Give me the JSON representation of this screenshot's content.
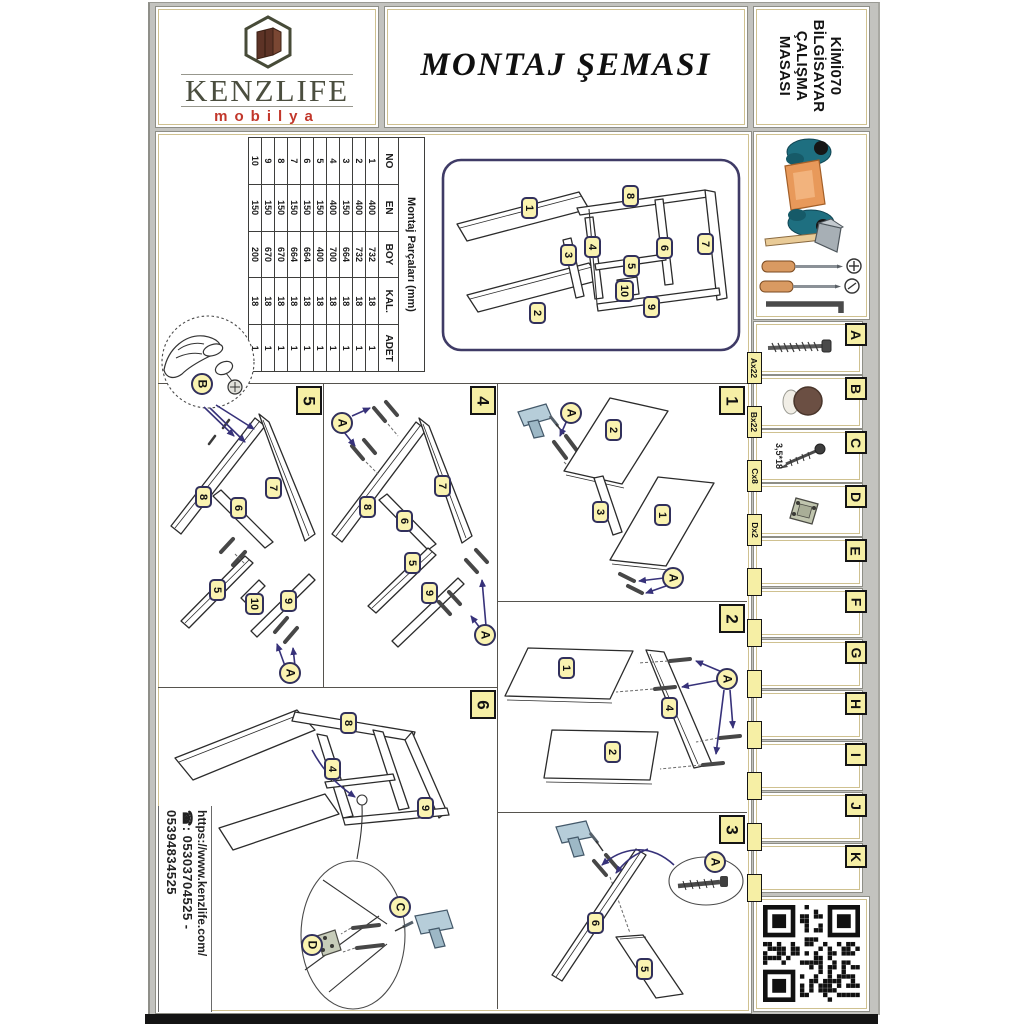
{
  "brand": {
    "name": "KENZLIFE",
    "sub": "mobilya"
  },
  "header": {
    "title": "MONTAJ ŞEMASI"
  },
  "product": {
    "line1": "KİMİ070",
    "line2": "BİLGİSAYAR",
    "line3": "ÇALIŞMA",
    "line4": "MASASI"
  },
  "contact": {
    "phone_icon": "☎",
    "phone": ": 05303704525 - 05394834525",
    "url": "https://www.kenzlife.com/"
  },
  "parts_table": {
    "title": "Montaj Parçaları (mm)",
    "headers": {
      "no": "NO",
      "en": "EN",
      "boy": "BOY",
      "kal": "KAL.",
      "adet": "ADET"
    },
    "rows": [
      {
        "no": "1",
        "en": "400",
        "boy": "732",
        "kal": "18",
        "adet": "1"
      },
      {
        "no": "2",
        "en": "400",
        "boy": "732",
        "kal": "18",
        "adet": "1"
      },
      {
        "no": "3",
        "en": "150",
        "boy": "664",
        "kal": "18",
        "adet": "1"
      },
      {
        "no": "4",
        "en": "400",
        "boy": "700",
        "kal": "18",
        "adet": "1"
      },
      {
        "no": "5",
        "en": "150",
        "boy": "400",
        "kal": "18",
        "adet": "1"
      },
      {
        "no": "6",
        "en": "150",
        "boy": "664",
        "kal": "18",
        "adet": "1"
      },
      {
        "no": "7",
        "en": "150",
        "boy": "664",
        "kal": "18",
        "adet": "1"
      },
      {
        "no": "8",
        "en": "150",
        "boy": "670",
        "kal": "18",
        "adet": "1"
      },
      {
        "no": "9",
        "en": "150",
        "boy": "670",
        "kal": "18",
        "adet": "1"
      },
      {
        "no": "10",
        "en": "150",
        "boy": "200",
        "kal": "18",
        "adet": "1"
      }
    ]
  },
  "hardware": {
    "letters": {
      "a": "A",
      "b": "B",
      "c": "C",
      "d": "D",
      "e": "E",
      "f": "F",
      "g": "G",
      "h": "H",
      "i": "I",
      "j": "J",
      "k": "K"
    },
    "counts": {
      "a": "Ax22",
      "b": "Bx22",
      "c": "Cx8",
      "d": "Dx2"
    },
    "screw_size": "3,5*18"
  },
  "part_numbers": {
    "p1": "1",
    "p2": "2",
    "p3": "3",
    "p4": "4",
    "p5": "5",
    "p6": "6",
    "p7": "7",
    "p8": "8",
    "p9": "9",
    "p10": "10"
  },
  "step_numbers": {
    "s1": "1",
    "s2": "2",
    "s3": "3",
    "s4": "4",
    "s5": "5",
    "s6": "6"
  },
  "fasteners": {
    "a": "A",
    "b": "B",
    "c": "C",
    "d": "D"
  }
}
